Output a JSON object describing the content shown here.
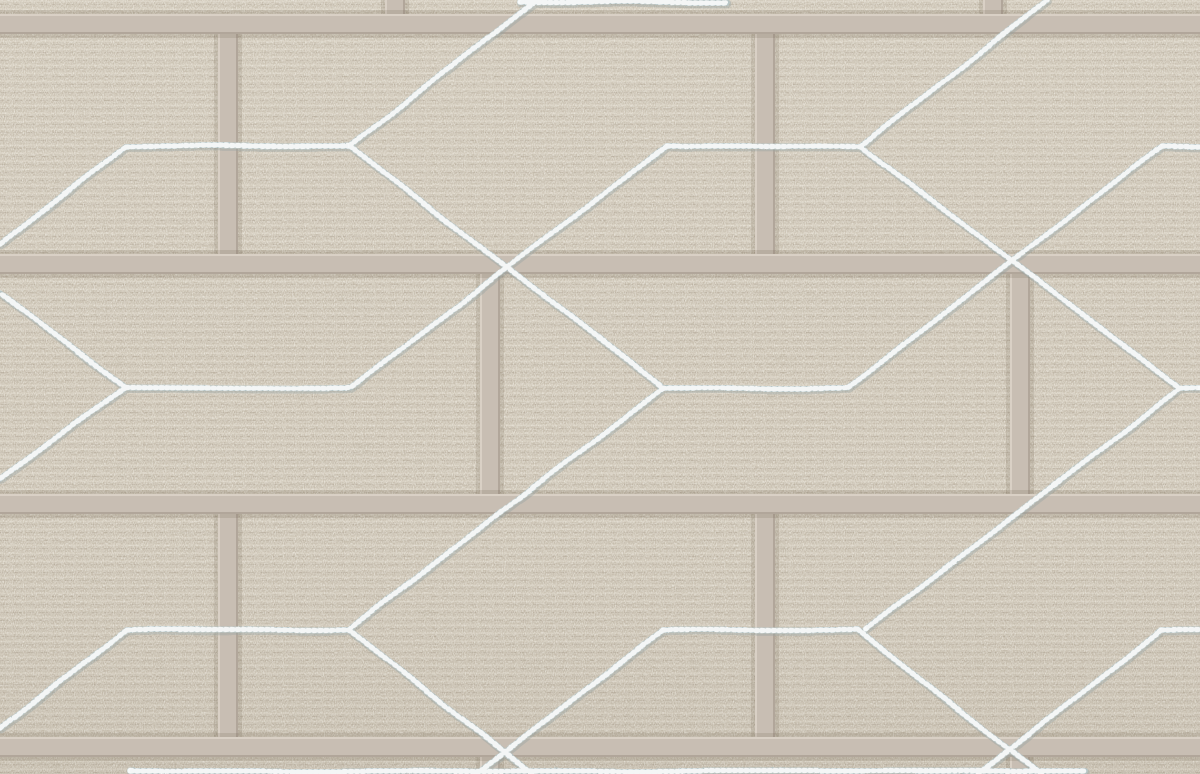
{
  "image": {
    "kind": "wallpaper-texture-photograph",
    "subject": "taupe fabric-effect brick wallpaper with raised mortar joints and metallic silver chain-stitch geometric hexagon lines",
    "width_px": 1200,
    "height_px": 774
  },
  "palette": {
    "fabric_base": "#c7beae",
    "fabric_glow": "rgba(255,252,240,0.05)",
    "weave_light": "rgba(246,241,228,0.40)",
    "weave_dark": "rgba(120,107,86,0.20)",
    "weave_dash": "rgba(255,255,255,0.16)",
    "fleck_light_r": 0.96,
    "fleck_light_g": 0.94,
    "fleck_light_b": 0.88,
    "fleck_dark_r": 0.5,
    "fleck_dark_g": 0.45,
    "fleck_dark_b": 0.36,
    "mottle_r": 0.44,
    "mottle_g": 0.4,
    "mottle_b": 0.31,
    "mortar_fill": "#c8beb3",
    "mortar_top_edge": "#d9d0c5",
    "mortar_bottom_edge": "#b1a69a",
    "mortar_outer_shadow": "rgba(90,76,56,0.14)",
    "stitch_core": "#cfd9d9",
    "stitch_sparkle": "#ffffff",
    "stitch_chain_dark": "#a3b2b2",
    "stitch_shadow": "#96a2a3"
  },
  "mortar": {
    "band_thickness": 20,
    "h_band_tops": [
      14,
      254,
      494,
      737
    ],
    "v_band_rows": [
      {
        "x_centers": [
          395,
          993
        ],
        "y_top": 0,
        "y_bottom": 14
      },
      {
        "x_centers": [
          228,
          765
        ],
        "y_top": 34,
        "y_bottom": 254
      },
      {
        "x_centers": [
          490,
          1020
        ],
        "y_top": 274,
        "y_bottom": 494
      },
      {
        "x_centers": [
          228,
          765
        ],
        "y_top": 514,
        "y_bottom": 737
      },
      {
        "x_centers": [
          490,
          1020
        ],
        "y_top": 757,
        "y_bottom": 774
      }
    ]
  },
  "stitch": {
    "stroke_width": 6,
    "segments": [
      [
        0,
        244,
        127,
        146
      ],
      [
        127,
        146,
        350,
        146
      ],
      [
        350,
        146,
        537,
        0
      ],
      [
        350,
        146,
        663,
        388
      ],
      [
        667,
        146,
        860,
        146
      ],
      [
        667,
        146,
        350,
        388
      ],
      [
        860,
        146,
        1048,
        0
      ],
      [
        860,
        146,
        1180,
        388
      ],
      [
        1162,
        146,
        1200,
        146
      ],
      [
        1162,
        146,
        847,
        388
      ],
      [
        125,
        387,
        0,
        293
      ],
      [
        125,
        387,
        0,
        478
      ],
      [
        125,
        387,
        350,
        388
      ],
      [
        663,
        388,
        847,
        388
      ],
      [
        663,
        388,
        348,
        630
      ],
      [
        1180,
        388,
        865,
        630
      ],
      [
        1180,
        388,
        1200,
        388
      ],
      [
        0,
        728,
        127,
        630
      ],
      [
        127,
        630,
        348,
        630
      ],
      [
        348,
        630,
        533,
        774
      ],
      [
        662,
        630,
        857,
        630
      ],
      [
        662,
        630,
        477,
        774
      ],
      [
        857,
        630,
        1041,
        774
      ],
      [
        1162,
        630,
        1200,
        630
      ],
      [
        1162,
        630,
        978,
        774
      ],
      [
        520,
        2,
        727,
        2
      ],
      [
        130,
        771,
        1085,
        771
      ]
    ]
  }
}
